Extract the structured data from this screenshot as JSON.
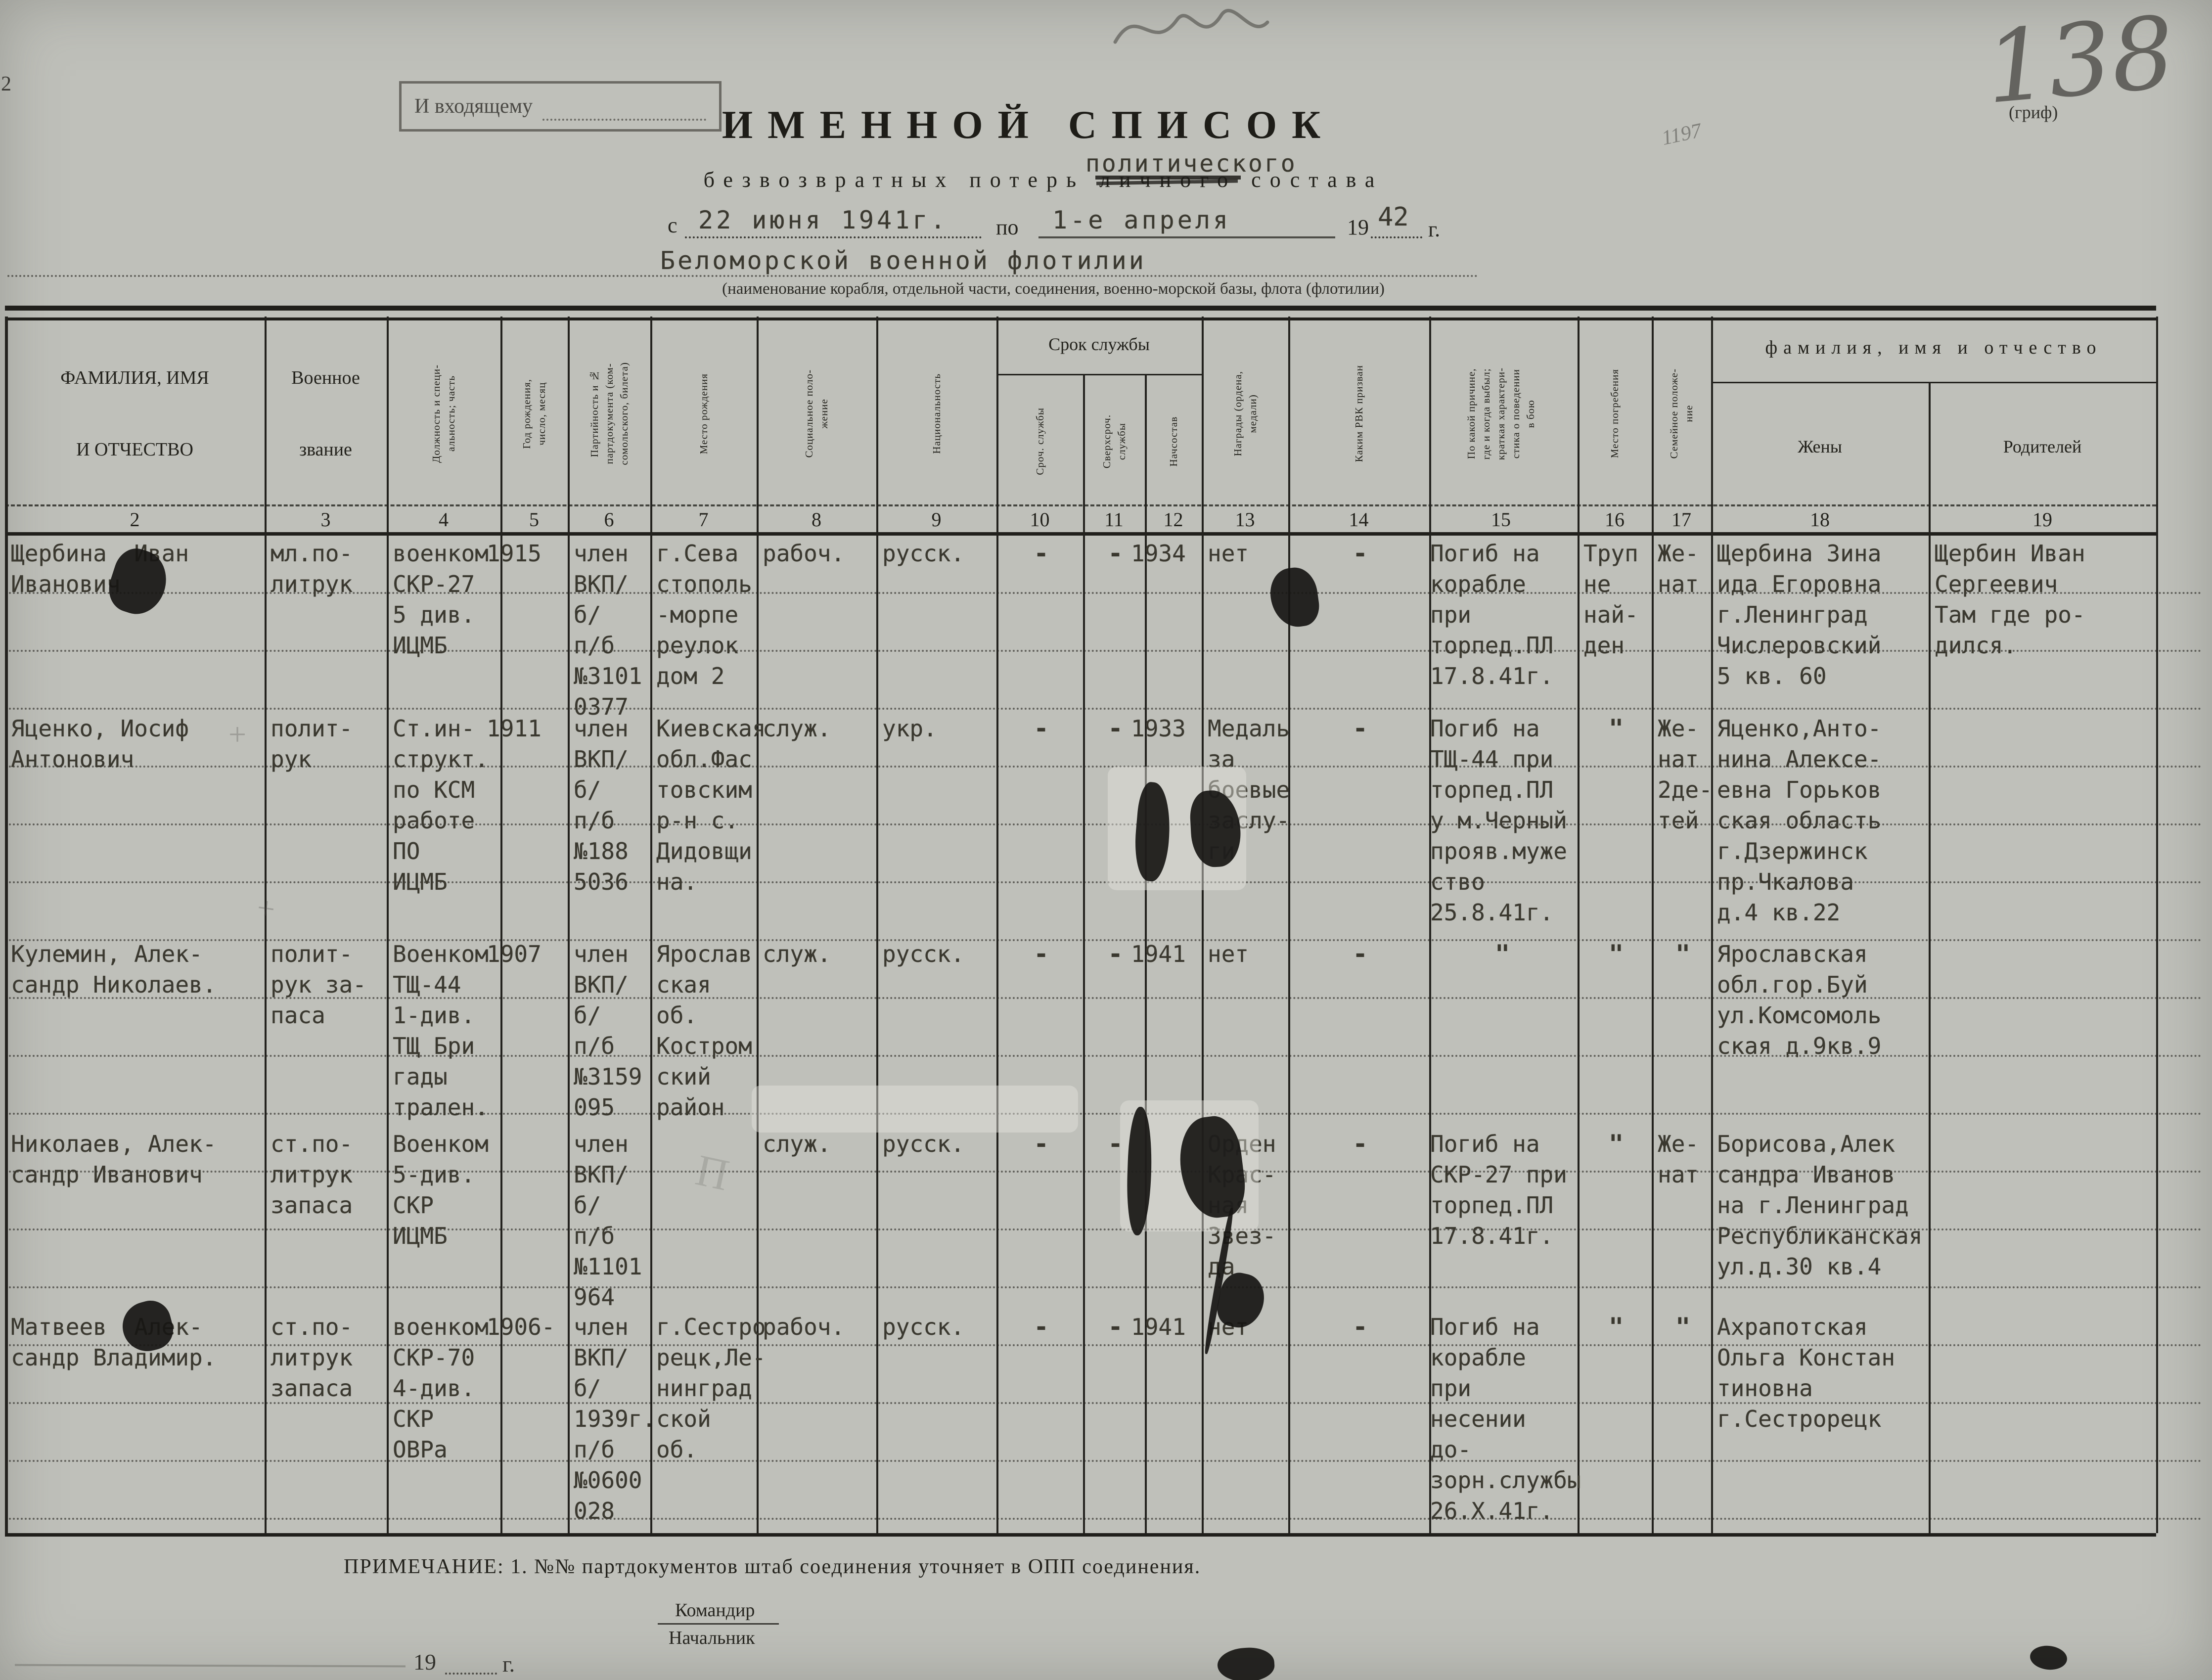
{
  "page": {
    "corner_number": "2",
    "folio_number": "138",
    "grif_caption": "(гриф)",
    "incoming_stamp": "И входящему",
    "pencil_note": "1197",
    "pencil_letter": "П",
    "pencil_plus": "+"
  },
  "title": {
    "line1": "ИМЕННОЙ СПИСОК",
    "overtype": "политического",
    "line2_prefix": "безвозвратных потерь",
    "struck_word": "личного",
    "line2_suffix": "состава",
    "period_from_label": "с",
    "period_from_value": "22 июня 1941г.",
    "period_to_label": "по",
    "period_to_value": "1-е апреля",
    "period_year_prefix": "19",
    "period_year_value": "42",
    "period_year_suffix": "г.",
    "unit_name": "Беломорской военной флотилии",
    "unit_caption": "(наименование корабля, отдельной части, соединения, военно-морской базы, флота (флотилии)"
  },
  "table": {
    "group_service": "Срок службы",
    "group_family": "фамилия, имя и отчество",
    "columns": [
      {
        "num": "2",
        "label": "ФАМИЛИЯ, ИМЯ\nИ ОТЧЕСТВО"
      },
      {
        "num": "3",
        "label": "Военное\nзвание"
      },
      {
        "num": "4",
        "label": "Должность и специ-\nальность; часть"
      },
      {
        "num": "5",
        "label": "Год рождения,\nчисло, месяц"
      },
      {
        "num": "6",
        "label": "Партийность и №\nпартдокумента (ком-\nсомольского, билета)"
      },
      {
        "num": "7",
        "label": "Место рождения"
      },
      {
        "num": "8",
        "label": "Социальное поло-\nжение"
      },
      {
        "num": "9",
        "label": "Национальность"
      },
      {
        "num": "10",
        "label": "Сроч. службы"
      },
      {
        "num": "11",
        "label": "Сверхсроч.\nслужбы"
      },
      {
        "num": "12",
        "label": "Начсостав"
      },
      {
        "num": "13",
        "label": "Награды (ордена,\nмедали)"
      },
      {
        "num": "14",
        "label": "Каким РВК призван"
      },
      {
        "num": "15",
        "label": "По какой причине,\nгде и когда выбыл;\nкраткая характери-\nстика о поведении\nв бою"
      },
      {
        "num": "16",
        "label": "Место погребения"
      },
      {
        "num": "17",
        "label": "Семейное положе-\nние"
      },
      {
        "num": "18",
        "label": "Жены"
      },
      {
        "num": "19",
        "label": "Родителей"
      }
    ],
    "rows": [
      {
        "c2": "Щербина  Иван\nИванович",
        "c3": "мл.по-\nлитрук",
        "c4": "военком\nСКР-27\n5 див.\nИЦМБ",
        "c5": "1915",
        "c6": "член\nВКП/б/\nп/б\n№3101\n0377",
        "c7": "г.Сева\nстополь\n-морпе\nреулок\nдом 2",
        "c8": "рабоч.",
        "c9": "русск.",
        "c10": "-",
        "c11": "-",
        "c12": "1934",
        "c13": "нет",
        "c14": "-",
        "c15": "Погиб на\nкорабле при\nторпед.ПЛ\n17.8.41г.",
        "c16": "Труп\nне\nнай-\nден",
        "c17": "Же-\nнат",
        "c18": "Щербина Зина\nида Егоровна\nг.Ленинград\nЧислеровский\n5 кв. 60",
        "c19": "Щербин Иван\nСергеевич\nТам где ро-\nдился."
      },
      {
        "c2": "Яценко, Иосиф\nАнтонович",
        "c3": "полит-\nрук",
        "c4": "Ст.ин-\nструкт.\nпо КСМ\nработе\nПО\nИЦМБ",
        "c5": "1911",
        "c6": "член\nВКП/б/\nп/б\n№188\n5036",
        "c7": "Киевская\nобл.Фас\nтовским\nр-н с.\nДидовщи\nна.",
        "c8": "служ.",
        "c9": "укр.",
        "c10": "-",
        "c11": "-",
        "c12": "1933",
        "c13": "Медаль\nза\nбоевые\nзаслу-\nги",
        "c14": "-",
        "c15": "Погиб на\nТЩ-44 при\nторпед.ПЛ\nу м.Черный\nпрояв.муже\nство\n25.8.41г.",
        "c16": "\"",
        "c17": "Же-\nнат\n2де-\nтей",
        "c18": "Яценко,Анто-\nнина Алексе-\nевна Горьков\nская область\nг.Дзержинск\nпр.Чкалова\nд.4 кв.22",
        "c19": ""
      },
      {
        "c2": "Кулемин, Алек-\nсандр Николаев.",
        "c3": "полит-\nрук за-\nпаса",
        "c4": "Военком\nТЩ-44\n1-див.\nТЩ Бри\nгады\nтрален.",
        "c5": "1907",
        "c6": "член\nВКП/б/\nп/б\n№3159\n095",
        "c7": "Ярослав\nская об.\nКостром\nский\nрайон",
        "c8": "служ.",
        "c9": "русск.",
        "c10": "-",
        "c11": "-",
        "c12": "1941",
        "c13": "нет",
        "c14": "-",
        "c15": "\"",
        "c16": "\"",
        "c17": "\"",
        "c18": "Ярославская\nобл.гор.Буй\nул.Комсомоль\nская д.9кв.9",
        "c19": ""
      },
      {
        "c2": "Николаев, Алек-\nсандр Иванович",
        "c3": "ст.по-\nлитрук\nзапаса",
        "c4": "Военком\n5-див.\nСКР\nИЦМБ",
        "c5": "",
        "c6": "член\nВКП/б/\nп/б\n№1101\n964",
        "c7": "",
        "c8": "служ.",
        "c9": "русск.",
        "c10": "-",
        "c11": "-",
        "c12": "",
        "c13": "Орден\nКрас-\nная\nЗвез-\nда",
        "c14": "-",
        "c15": "Погиб на\nСКР-27 при\nторпед.ПЛ\n17.8.41г.",
        "c16": "\"",
        "c17": "Же-\nнат",
        "c18": "Борисова,Алек\nсандра Иванов\nна г.Ленинград\nРеспубликанская\nул.д.30 кв.4",
        "c19": ""
      },
      {
        "c2": "Матвеев  Алек-\nсандр Владимир.",
        "c3": "ст.по-\nлитрук\nзапаса",
        "c4": "военком\nСКР-70\n4-див.\nСКР\nОВРа",
        "c5": "1906-",
        "c6": "член\nВКП/б/\n1939г.\nп/б\n№0600\n028",
        "c7": "г.Сестро\nрецк,Ле-\nнинград\nской об.",
        "c8": "рабоч.",
        "c9": "русск.",
        "c10": "-",
        "c11": "-",
        "c12": "1941",
        "c13": "нет",
        "c14": "-",
        "c15": "Погиб на\nкорабле при\nнесении до-\nзорн.службы\n26.Х.41г.",
        "c16": "\"",
        "c17": "\"",
        "c18": "Ахрапотская\nОльга Констан\nтиновна\nг.Сестрорецк",
        "c19": ""
      }
    ]
  },
  "footer": {
    "note": "ПРИМЕЧАНИЕ: 1. №№ партдокументов штаб соединения уточняет в ОПП соединения.",
    "signature_role_1": "Командир",
    "signature_role_2": "Начальник",
    "year_prefix": "19",
    "year_suffix": "г."
  }
}
